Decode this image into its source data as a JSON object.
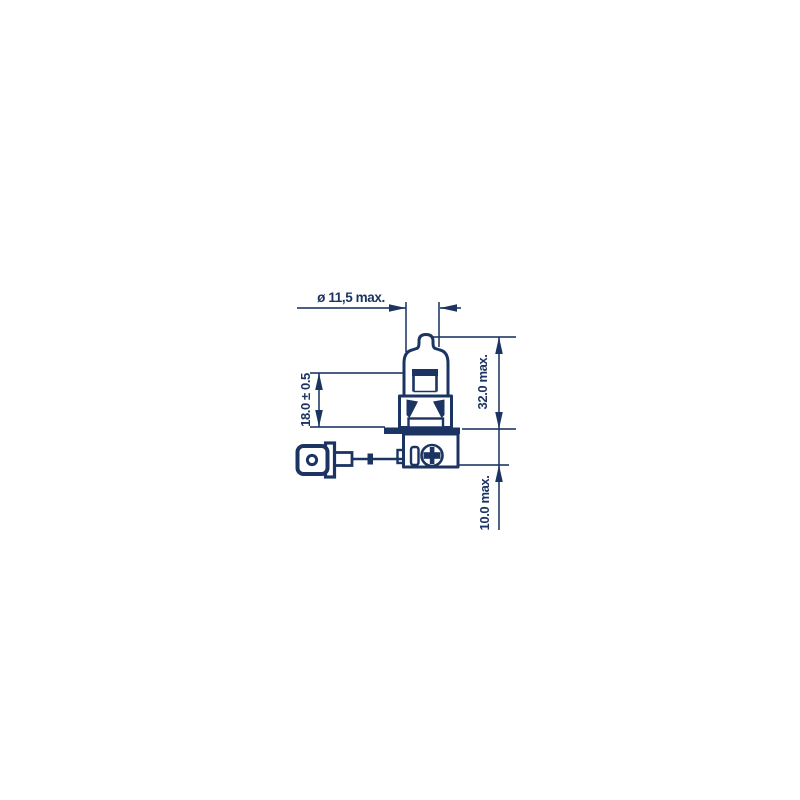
{
  "figure": {
    "ink_color": "#1b3462",
    "background_color": "#ffffff"
  },
  "dimensions": {
    "diameter_label": "ø 11,5 max.",
    "envelope_length_label": "18.0 ± 0.5",
    "overall_length_label": "32.0 max.",
    "base_depth_label": "10.0 max."
  }
}
